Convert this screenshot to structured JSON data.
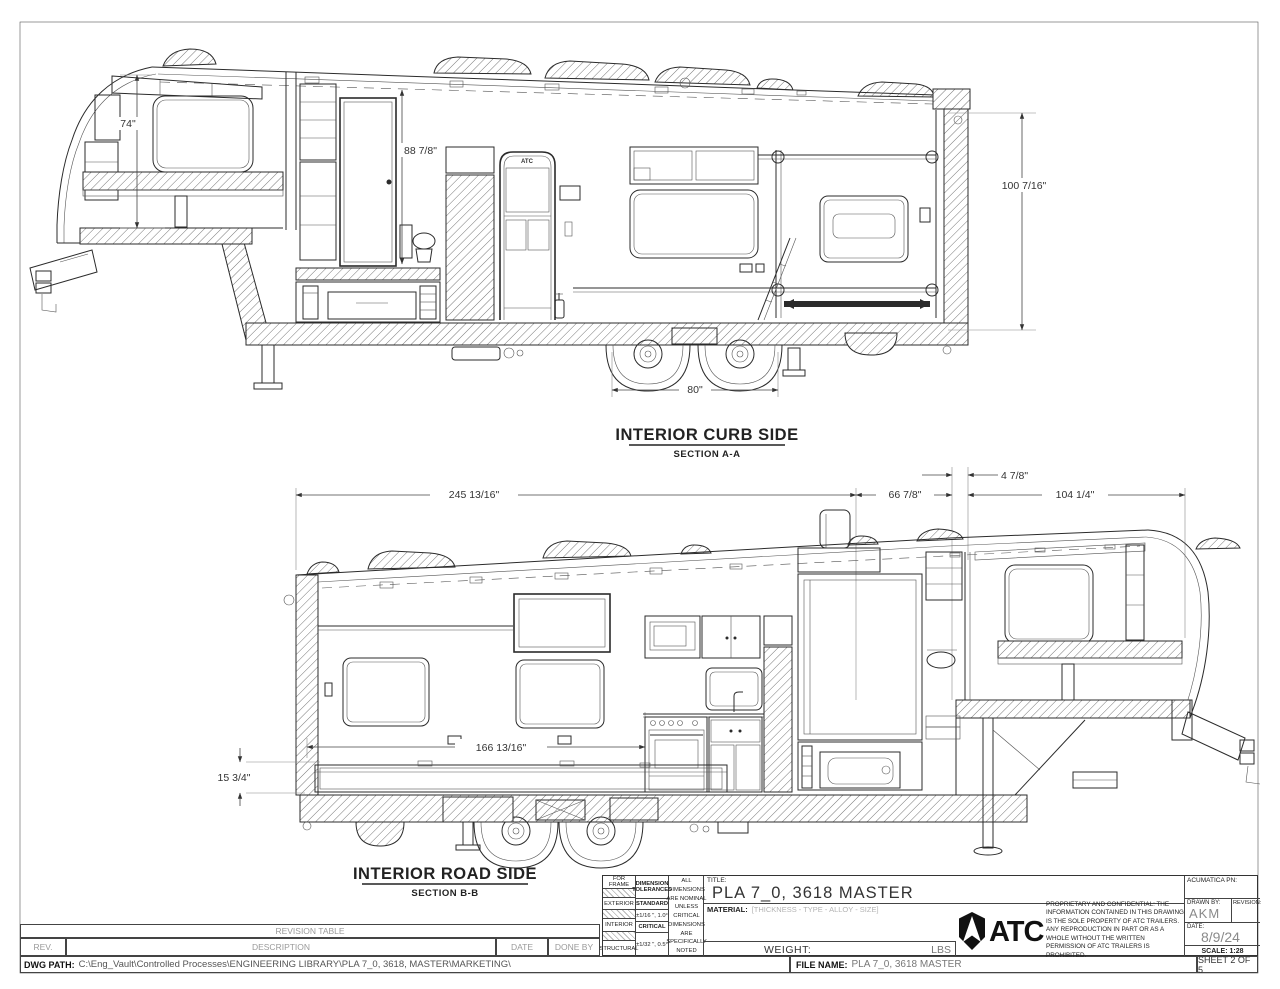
{
  "views": {
    "curb": {
      "title": "INTERIOR CURB SIDE",
      "section": "SECTION A-A",
      "door_logo": "ATC",
      "dims": {
        "bedroom_height": "74\"",
        "closet_height": "88 7/8\"",
        "rear_height": "100 7/16\"",
        "axle_span": "80\""
      }
    },
    "road": {
      "title": "INTERIOR ROAD SIDE",
      "section": "SECTION B-B",
      "dims": {
        "rear_span": "245 13/16\"",
        "mid_span": "66 7/8\"",
        "cap_offset": "4 7/8\"",
        "front_span": "104 1/4\"",
        "interior_span": "166 13/16\"",
        "rail_height": "15 3/4\""
      }
    }
  },
  "revision_table": {
    "title": "REVISION TABLE",
    "columns": [
      "REV.",
      "DESCRIPTION",
      "DATE",
      "DONE BY"
    ]
  },
  "dwg_path_label": "DWG PATH:",
  "dwg_path": "C:\\Eng_Vault\\Controlled Processes\\ENGINEERING LIBRARY\\PLA 7_0, 3618, MASTER\\MARKETING\\",
  "title_block": {
    "tolerances": {
      "row_frame": "FOR FRAME",
      "row_exterior": "EXTERIOR",
      "row_interior": "INTERIOR",
      "row_structural": "STRUCTURAL",
      "header": "DIMENSION TOLERANCES",
      "standard_label": "STANDARD",
      "standard_value": "±1/16 \", 1.0°",
      "critical_label": "CRITICAL",
      "critical_value": "±1/32 \", 0.5°",
      "note": "ALL DIMENSIONS ARE NOMINAL UNLESS CRITICAL DIMENSIONS ARE SPECIFICALLY NOTED"
    },
    "title_label": "TITLE:",
    "title": "PLA 7_0, 3618 MASTER",
    "material_label": "MATERIAL:",
    "material_value": "[THICKNESS - TYPE - ALLOY - SIZE]",
    "weight_label": "WEIGHT:",
    "weight_unit": "LBS",
    "file_name_label": "FILE NAME:",
    "file_name": "PLA 7_0, 3618 MASTER",
    "logo_text": "ATC",
    "proprietary": "PROPRIETARY AND CONFIDENTIAL: THE INFORMATION CONTAINED IN THIS DRAWING IS THE SOLE PROPERTY OF ATC TRAILERS. ANY REPRODUCTION IN PART OR AS A WHOLE WITHOUT THE WRITTEN PERMISSION OF ATC TRAILERS IS PROHIBITED.",
    "acumatica_label": "ACUMATICA PN:",
    "drawn_by_label": "DRAWN BY:",
    "drawn_by": "AKM",
    "revision_label": "REVISION:",
    "date_label": "DATE:",
    "date": "8/9/24",
    "scale": "SCALE: 1:28",
    "sheet": "SHEET 2 OF 5"
  }
}
